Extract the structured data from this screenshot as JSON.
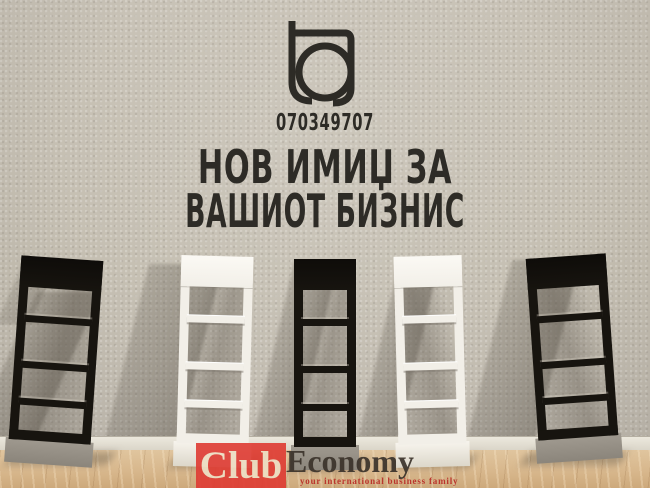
{
  "ad": {
    "phone": "070349707",
    "headline_line1": "НОВ ИМИЏ ЗА",
    "headline_line2": "ВАШИОТ БИЗНИС",
    "logo_icon": "tq-monogram-icon"
  },
  "scene": {
    "racks": [
      {
        "finish": "black",
        "position": "far-left"
      },
      {
        "finish": "white",
        "position": "left"
      },
      {
        "finish": "black",
        "position": "center"
      },
      {
        "finish": "white",
        "position": "right"
      },
      {
        "finish": "black",
        "position": "far-right"
      }
    ]
  },
  "watermark": {
    "club_label": "Club",
    "economy_label": "Economy",
    "tagline": "your international business family"
  },
  "colors": {
    "ink": "#2d2b26",
    "wall": "#c6c0b4",
    "floor": "#d7b68b",
    "baseboard": "#ece8dd",
    "rackBlack": "#17140f",
    "rackWhite": "#f2efe8",
    "rackBaseGray": "#a09a90",
    "clubRed": "#df3b33",
    "clubText": "#eedfc4",
    "economyInk": "#3b332b",
    "taglineRed": "#bb362d"
  }
}
